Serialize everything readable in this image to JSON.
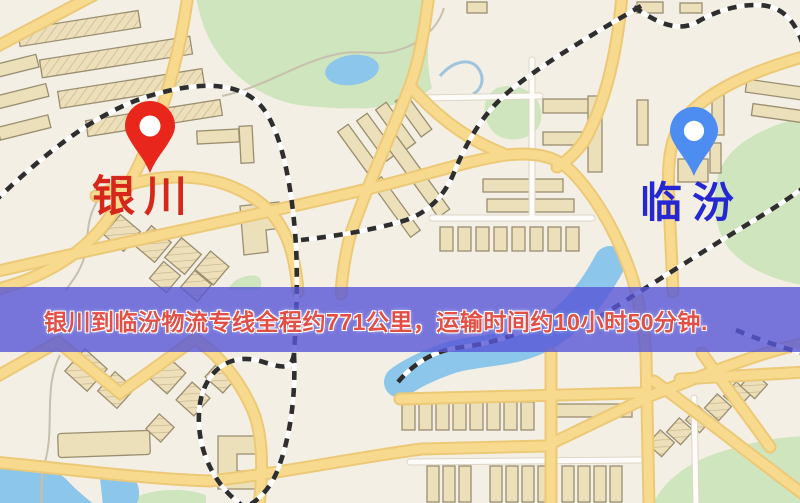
{
  "banner": {
    "text": "银川到临汾物流专线全程约771公里，运输时间约10小时50分钟.",
    "background_color": "#5856d7",
    "text_color": "#e14f46"
  },
  "markers": {
    "origin": {
      "label": "银川",
      "pin_color": "#e9261c",
      "label_color": "#d5281b"
    },
    "destination": {
      "label": "临汾",
      "pin_color": "#4d8df2",
      "label_color": "#2427d2"
    }
  },
  "map_colors": {
    "background": "#f4efe5",
    "park": "#cfe5bd",
    "water": "#8cc6ea",
    "stream": "#c7c0ae",
    "road_major": "#f8da8e",
    "road_casing": "#ecc976",
    "road_minor": "#fdfcf8",
    "road_minor_casing": "#ddd6c6",
    "railway_dark": "#2e2e2e",
    "railway_light": "#ffffff",
    "building": "#ece0ba",
    "building_outline": "#9a8e70"
  }
}
